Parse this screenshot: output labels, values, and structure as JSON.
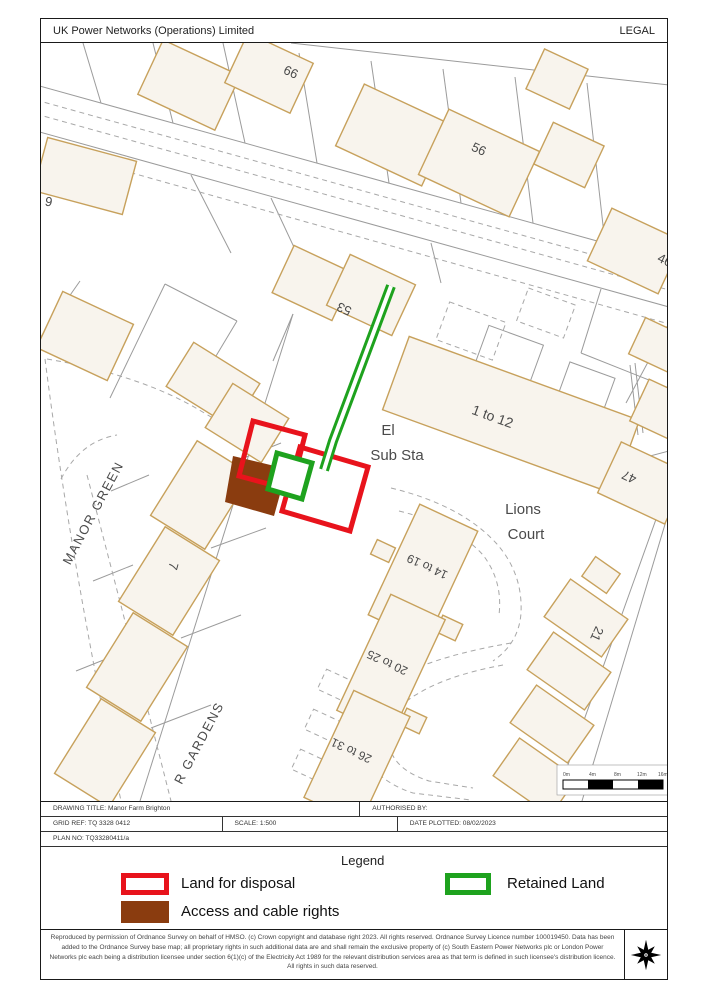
{
  "header": {
    "title": "UK Power Networks (Operations) Limited",
    "doc_type": "LEGAL"
  },
  "map": {
    "labels": {
      "n66": "66",
      "n56": "56",
      "n46": "46",
      "n9": "9",
      "n53": "53",
      "n7": "7",
      "n47": "47",
      "n21": "21",
      "b1to12": "1 to 12",
      "b14to19": "14 to 19",
      "b20to25": "20 to 25",
      "b26to31": "26 to 31",
      "el": "El",
      "sub_sta": "Sub Sta",
      "lions": "Lions",
      "court": "Court",
      "manor_green": "MANOR GREEN",
      "gardens": "R GARDENS"
    },
    "scale_bar": {
      "ticks": [
        "0m",
        "4m",
        "8m",
        "12m",
        "16m"
      ]
    },
    "colors": {
      "land_for_disposal": "#e8131c",
      "retained_land": "#1ea21e",
      "access_cable_rights": "#8a3c0f",
      "building_fill": "#f8f4ed",
      "building_outline": "#c7a15c",
      "boundary_gray": "#9b9b9b"
    }
  },
  "info_bar": {
    "drawing_title": "DRAWING TITLE: Manor Farm Brighton",
    "authorised_by": "AUTHORISED BY:",
    "grid_ref": "GRID REF: TQ 3328 0412",
    "scale": "SCALE: 1:500",
    "date_plotted": "DATE PLOTTED: 08/02/2023",
    "plan_no": "PLAN NO: TQ33280411/a"
  },
  "legend": {
    "title": "Legend",
    "items": [
      {
        "label": "Land for disposal",
        "swatch": "red-outline"
      },
      {
        "label": "Retained Land",
        "swatch": "green-outline"
      },
      {
        "label": "Access and cable rights",
        "swatch": "brown-fill"
      }
    ]
  },
  "footer": {
    "copyright": "Reproduced by permission of Ordnance Survey on behalf of HMSO. (c) Crown copyright and database right 2023. All rights reserved. Ordnance Survey Licence number 100019450. Data has been added to the Ordnance Survey base map; all proprietary rights in such additional data are and shall remain the exclusive property of (c) South Eastern Power Networks plc or London Power Networks plc each being a distribution licensee under section 6(1)(c) of the Electricity Act 1989 for the relevant distribution services area as that term is defined in such licensee's distribution licence. All rights in such data reserved."
  }
}
